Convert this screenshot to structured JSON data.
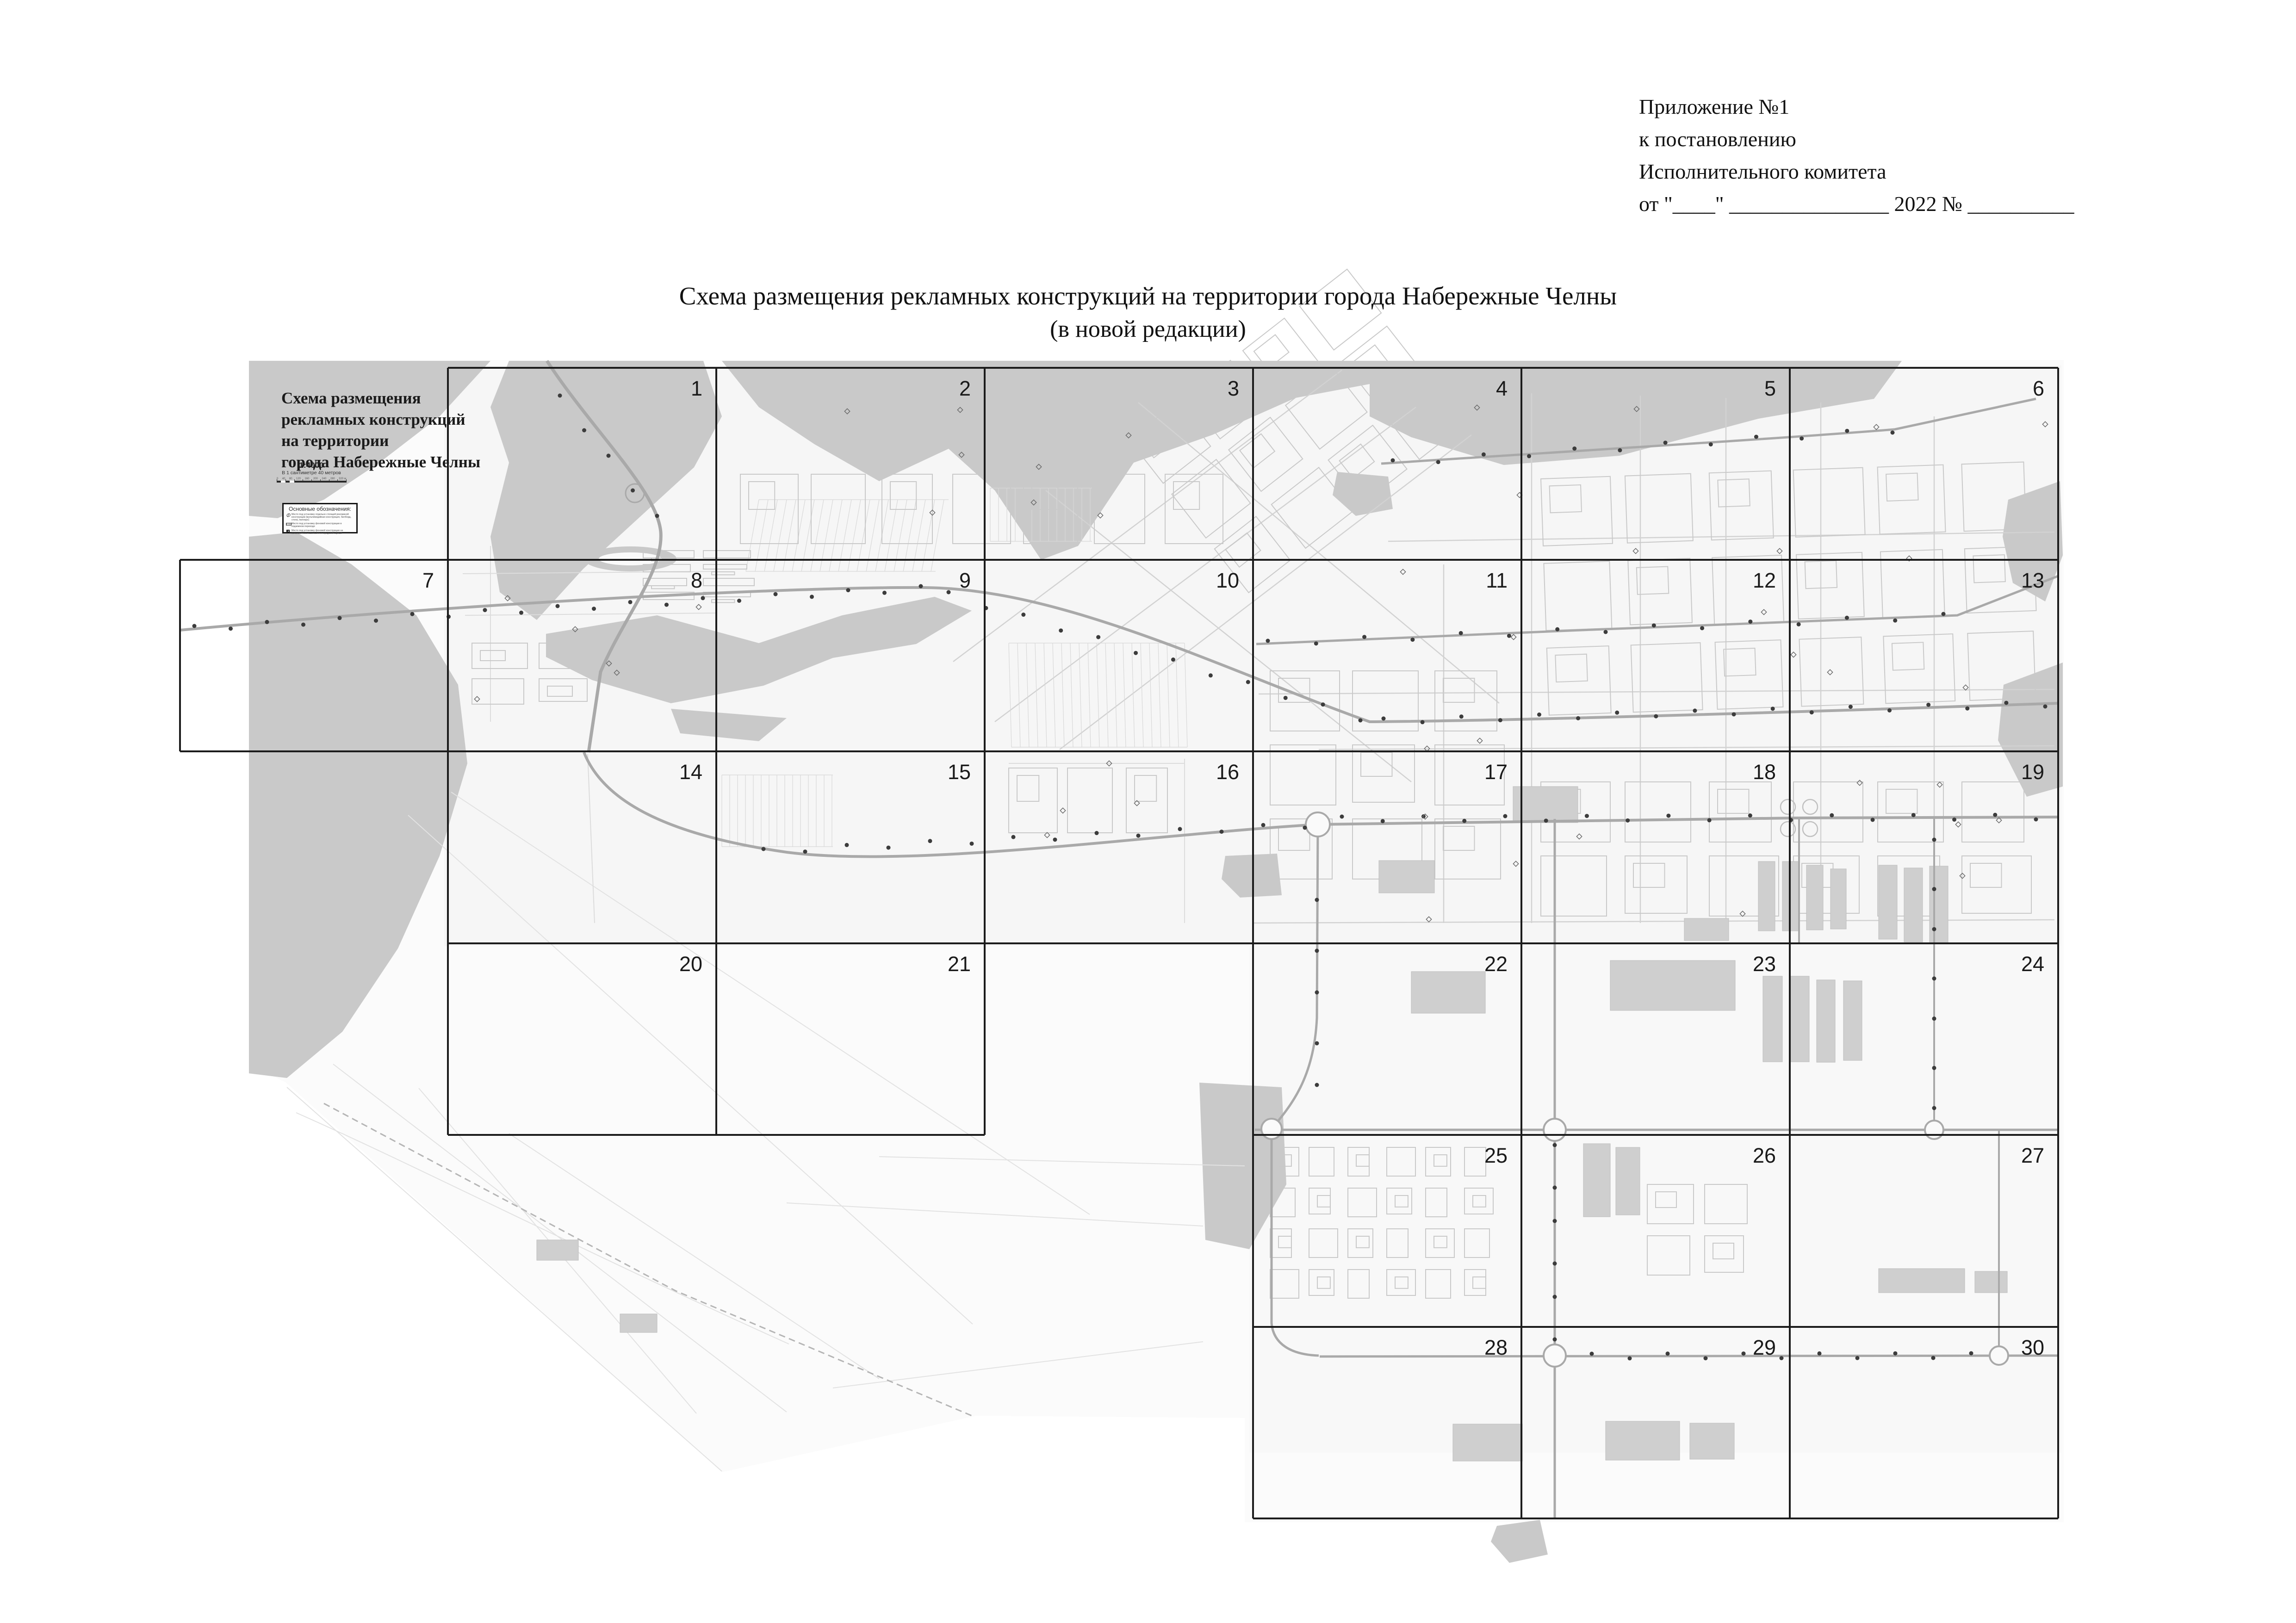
{
  "header": {
    "lines": [
      "Приложение №1",
      "к постановлению",
      "Исполнительного комитета",
      "от \"____\"  _______________ 2022 № __________"
    ]
  },
  "title": {
    "line1": "Схема размещения рекламных конструкций на территории города Набережные Челны",
    "line2": "(в новой редакции)"
  },
  "map": {
    "title_block": {
      "title_lines": [
        "Схема размещения",
        "рекламных конструкций",
        "на территории",
        "города Набережные Челны"
      ],
      "scale": "1:4000",
      "scale_note": "В 1 сантиметре 40 метров",
      "scale_bar_labels": [
        "0",
        "40",
        "80",
        "120",
        "160",
        "200",
        "240",
        "280",
        "320 м"
      ],
      "legend": {
        "heading": "Основные обозначения:",
        "items": [
          {
            "icon": "freestanding-construction-icon",
            "label": "Место под установку отдельно стоящей рекламной конструкции (мультимедийная конструкция, билборд, стела, пилларс)"
          },
          {
            "icon": "underpass-construction-icon",
            "label": "Место под установку фоновой конструкции в подземном переходе"
          },
          {
            "icon": "pavilion-construction-icon",
            "label": "Место под установку фоновой конструкции на остановочном павильоне и городской афише"
          }
        ]
      }
    },
    "grid_cells": [
      {
        "label": "1",
        "row": 1,
        "col": 2
      },
      {
        "label": "2",
        "row": 1,
        "col": 3
      },
      {
        "label": "3",
        "row": 1,
        "col": 4
      },
      {
        "label": "4",
        "row": 1,
        "col": 5
      },
      {
        "label": "5",
        "row": 1,
        "col": 6
      },
      {
        "label": "6",
        "row": 1,
        "col": 7
      },
      {
        "label": "7",
        "row": 2,
        "col": 1
      },
      {
        "label": "8",
        "row": 2,
        "col": 2
      },
      {
        "label": "9",
        "row": 2,
        "col": 3
      },
      {
        "label": "10",
        "row": 2,
        "col": 4
      },
      {
        "label": "11",
        "row": 2,
        "col": 5
      },
      {
        "label": "12",
        "row": 2,
        "col": 6
      },
      {
        "label": "13",
        "row": 2,
        "col": 7
      },
      {
        "label": "14",
        "row": 3,
        "col": 2
      },
      {
        "label": "15",
        "row": 3,
        "col": 3
      },
      {
        "label": "16",
        "row": 3,
        "col": 4
      },
      {
        "label": "17",
        "row": 3,
        "col": 5
      },
      {
        "label": "18",
        "row": 3,
        "col": 6
      },
      {
        "label": "19",
        "row": 3,
        "col": 7
      },
      {
        "label": "20",
        "row": 4,
        "col": 2
      },
      {
        "label": "21",
        "row": 4,
        "col": 3
      },
      {
        "label": "22",
        "row": 4,
        "col": 5
      },
      {
        "label": "23",
        "row": 4,
        "col": 6
      },
      {
        "label": "24",
        "row": 4,
        "col": 7
      },
      {
        "label": "25",
        "row": 5,
        "col": 5
      },
      {
        "label": "26",
        "row": 5,
        "col": 6
      },
      {
        "label": "27",
        "row": 5,
        "col": 7
      },
      {
        "label": "28",
        "row": 6,
        "col": 5
      },
      {
        "label": "29",
        "row": 6,
        "col": 6
      },
      {
        "label": "30",
        "row": 6,
        "col": 7
      }
    ]
  },
  "colors": {
    "water": "#c9c9c9",
    "map_base": "#fafafa",
    "road": "#a9a9a9",
    "grid_line": "#1c1c1c",
    "building": "#cfcfcf",
    "point_dot": "#3c3c3c"
  }
}
